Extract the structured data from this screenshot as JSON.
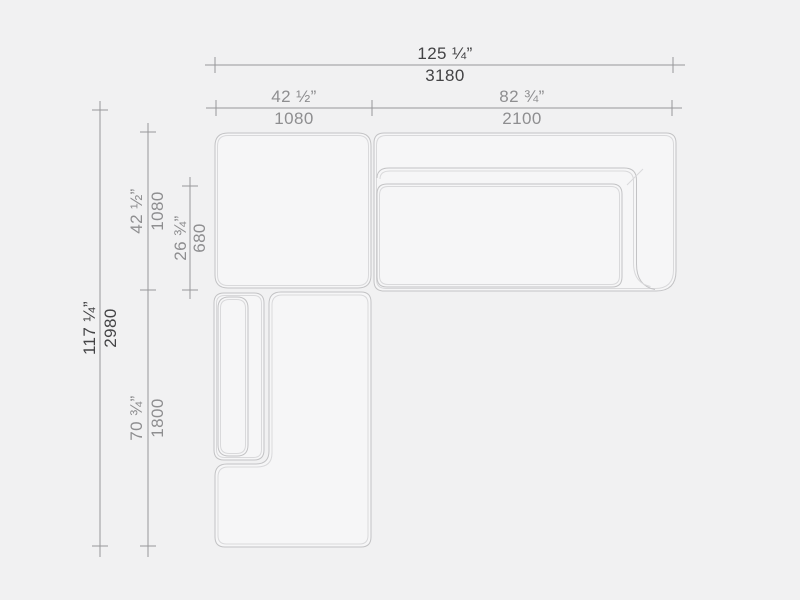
{
  "drawing": {
    "title": "sectional-sofa-top-view-dimension-drawing",
    "units": [
      "inches",
      "millimeters"
    ],
    "colors": {
      "background": "#f1f1f2",
      "piece_fill": "#f6f6f7",
      "outline": "#c3c3c5",
      "outline_inner": "#d9d9db",
      "dimension_line": "#98989a",
      "primary_label": "#434345",
      "secondary_label": "#8e8e90"
    },
    "dimensions": {
      "overall_width": {
        "inches": "125 ¼”",
        "mm": "3180"
      },
      "corner_width": {
        "inches": "42 ½”",
        "mm": "1080"
      },
      "chaise_width": {
        "inches": "82 ¾”",
        "mm": "2100"
      },
      "overall_depth": {
        "inches": "117 ¼”",
        "mm": "2980"
      },
      "corner_depth": {
        "inches": "42 ½”",
        "mm": "1080"
      },
      "seat_depth": {
        "inches": "26 ¾”",
        "mm": "680"
      },
      "bottom_depth": {
        "inches": "70 ¾”",
        "mm": "1800"
      }
    }
  }
}
